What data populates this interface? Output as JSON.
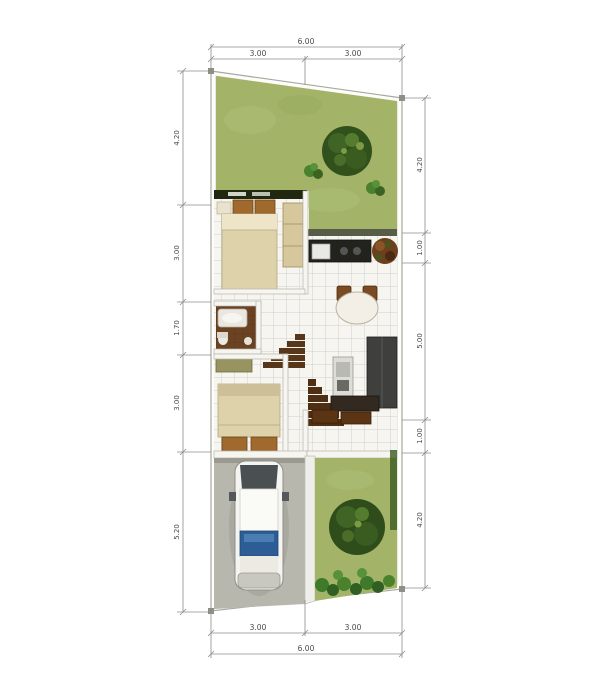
{
  "plan": {
    "dimensions": {
      "top": {
        "total": "6.00",
        "segments": [
          "3.00",
          "3.00"
        ]
      },
      "bottom": {
        "total": "6.00",
        "segments": [
          "3.00",
          "3.00"
        ]
      },
      "left": {
        "segments": [
          "4.20",
          "3.00",
          "1.70",
          "3.00",
          "5.20"
        ]
      },
      "right": {
        "segments": [
          "4.20",
          "1.00",
          "5.00",
          "1.00",
          "4.20"
        ]
      }
    },
    "palette": {
      "grass": "#a3b469",
      "tree": "#31511c",
      "floor": "#f7f5ef",
      "tile_line": "#ccd0d6",
      "wall": "#f6f5f0",
      "wall_edge": "#b5b5ac",
      "carport": "#b7b7ae",
      "bathroom_floor": "#6b4323",
      "bed": "#ded2ab",
      "pillow": "#a06a2e",
      "dark_furniture": "#3f3f3d",
      "car_window_blue": "#2d5d95",
      "dimension_line": "#8c8c8c"
    }
  }
}
